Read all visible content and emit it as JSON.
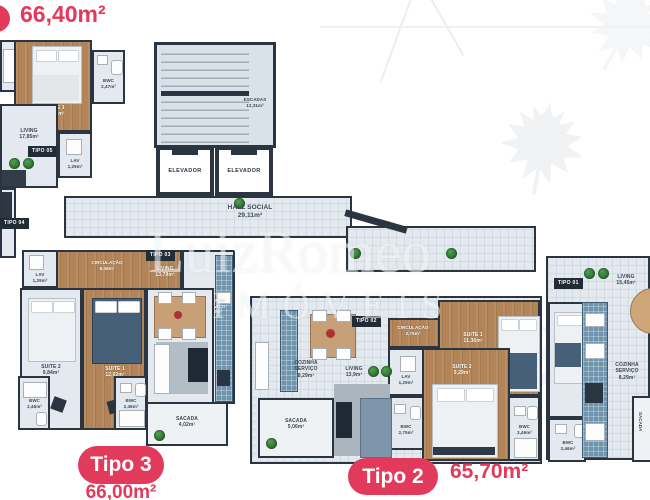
{
  "header": {
    "area": "66,40m²"
  },
  "watermark": {
    "line1": "LuizRomeo",
    "line2": "IMÓVEIS"
  },
  "core": {
    "escadas": "ESCADAS\n12,31m²",
    "elevador_left": "ELEVADOR",
    "elevador_right": "ELEVADOR",
    "hall": "HALL SOCIAL\n29,11m²"
  },
  "tipo05": {
    "badge": "TIPO 05",
    "suite1": "SUITE 1\n13,44m²",
    "bwc": "BWC\n2,47m²",
    "living": "LIVING\n17,85m²",
    "lav": "LAV\n1,29m²"
  },
  "tipo04": {
    "badge": "TIPO 04"
  },
  "tipo03": {
    "badge": "TIPO 03",
    "living": "LIVING\n13,79m²",
    "lav": "LAV\n1,29m²",
    "circulacao": "CIRCULAÇÃO\n8,08m²",
    "suite2": "SUITE 2\n9,84m²",
    "suite1": "SUITE 1\n12,02m²",
    "bwc1": "BWC\n2,46m²",
    "bwc2": "BWC\n2,46m²",
    "cozinha": "COZINHA\nSERVIÇO\n8,79m²",
    "sacada": "SACADA\n4,02m²",
    "pill": "Tipo 3",
    "area": "66,00m²"
  },
  "tipo02": {
    "badge": "TIPO 02",
    "cozinha": "COZINHA\nSERVIÇO\n8,29m²",
    "living": "LIVING\n13,9m²",
    "circulacao": "CIRCULAÇÃO\n2,75m²",
    "suite1": "SUITE 1\n11,36m²",
    "suite2": "SUITE 2\n9,29m²",
    "lav": "LAV\n1,29m²",
    "bwc1": "BWC\n2,75m²",
    "bwc2": "BWC\n2,46m²",
    "sacada": "SACADA\n5,06m²",
    "pill": "Tipo 2",
    "area": "65,70m²"
  },
  "tipo01": {
    "badge": "TIPO 01",
    "living": "LIVING\n15,45m²",
    "cozinha": "COZINHA\nSERVIÇO\n8,29m²",
    "bwc": "BWC\n2,46m²",
    "sacada": "SACADA"
  },
  "colors": {
    "accent": "#e23a5a",
    "wall": "#2b3541",
    "wood": "#b28457"
  }
}
